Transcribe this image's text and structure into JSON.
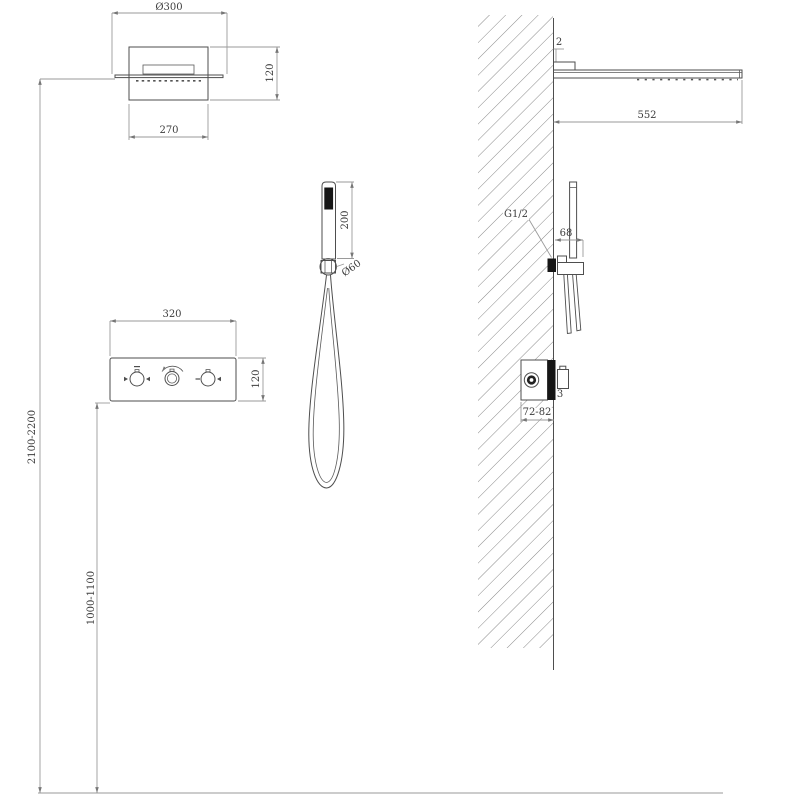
{
  "drawing": {
    "type": "shower-system-installation-diagram",
    "dims": {
      "head_front_diameter": "Ø300",
      "head_front_height": "120",
      "head_front_width": "270",
      "panel_width": "320",
      "panel_height": "120",
      "hand_shower_length": "200",
      "holder_diameter": "Ø60",
      "head_install_height": "2100-2200",
      "panel_install_height": "1000-1100",
      "head_plate_thickness": "2",
      "head_side_length": "552",
      "wall_thread": "G1/2",
      "bracket_offset": "68",
      "valve_trim_thickness": "3",
      "valve_embed_depth": "72-82"
    },
    "colors": {
      "background": "#ffffff",
      "object_line": "#4e4e4e",
      "dimension_line": "#9a9a9a",
      "hatch_line": "#8a8a8a",
      "dark_fill": "#161616",
      "text": "#3d3d3d"
    }
  }
}
